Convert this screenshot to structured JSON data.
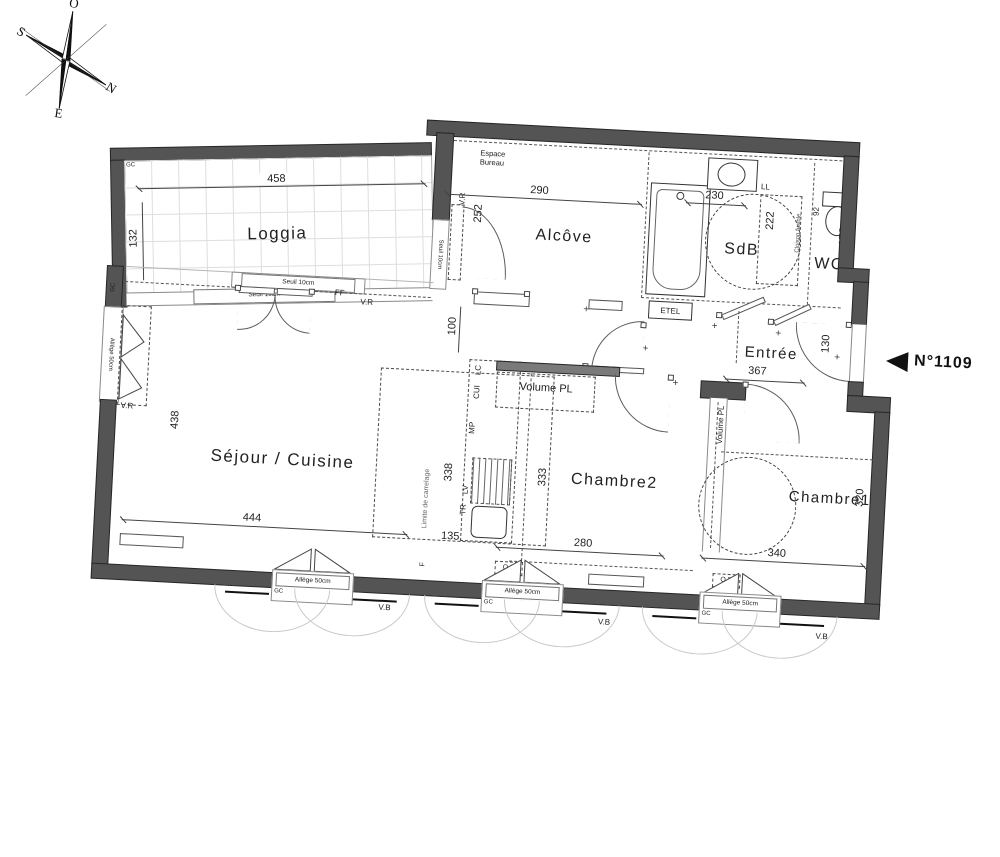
{
  "compass": {
    "top": "O",
    "right": "N",
    "bottom": "E",
    "left": "S"
  },
  "unit": {
    "number": "N°1109"
  },
  "rooms": {
    "loggia": {
      "name": "Loggia",
      "width": "458",
      "depth": "132"
    },
    "alcove": {
      "name": "Alcôve",
      "width": "290",
      "depth": "252",
      "zone": "Espace Bureau",
      "opening_dim": "100"
    },
    "sdb": {
      "name": "SdB",
      "width": "230",
      "depth": "222",
      "washer": "LL",
      "tech_box": "ETEL",
      "partition": "Cloison fusible"
    },
    "wc": {
      "name": "WC",
      "width": "92",
      "depth": "172"
    },
    "entree": {
      "name": "Entrée",
      "width": "367",
      "door_dim": "130",
      "closet": "Volume PL"
    },
    "sejour": {
      "name": "Séjour / Cuisine",
      "width": "444",
      "depth": "438"
    },
    "chambre2": {
      "name": "Chambre2",
      "width": "280",
      "depth": "333"
    },
    "chambre1": {
      "name": "Chambre1",
      "width": "340",
      "depth": "320",
      "closet": "Volume PL"
    }
  },
  "kitchen": {
    "lc": "LC",
    "cui": "CUI",
    "mp": "MP",
    "lv": "LV",
    "tr": "TR",
    "width": "135",
    "depth": "338",
    "vent": "F",
    "tiling_limit": "Limite de carrelage"
  },
  "openings": {
    "seuil": "Seuil 10cm",
    "allege": "Allège 50cm",
    "gc": "GC",
    "vb": "V.B",
    "qb": "Q.B",
    "vr": "V.R",
    "ff": "FF"
  }
}
